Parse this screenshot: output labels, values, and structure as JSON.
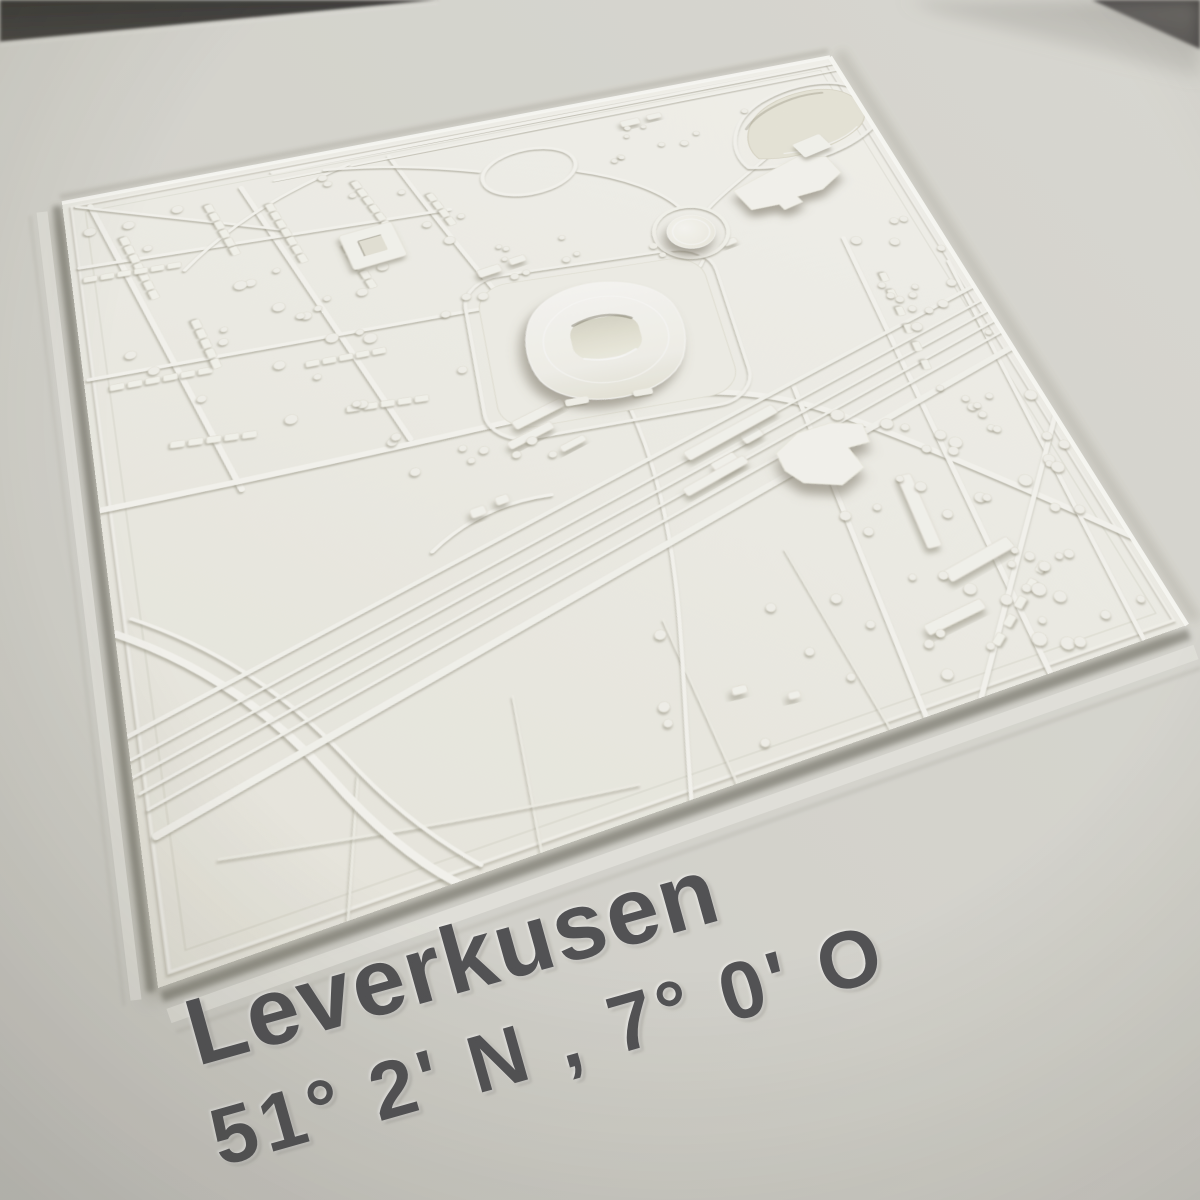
{
  "artwork": {
    "kind": "photograph of a white 3D-printed city relief map recessed in a paper mat",
    "city": "Leverkusen",
    "coordinates": "51° 2' N , 7° 0' O",
    "visible_features": [
      "stadium-bowl-with-recessed-pitch",
      "circular-gas-tank",
      "highway-interchange-loop",
      "pond-recess",
      "railway-track-band",
      "residential-house-rows",
      "tree-dots",
      "field-boundary-lines",
      "industrial-roof-blob",
      "courtyard-building"
    ]
  },
  "labels": {
    "city": "Leverkusen",
    "coords": "51° 2' N , 7° 0' O"
  },
  "palette": {
    "backdrop_dark": "#383633",
    "mat_paper": "#d7d6cf",
    "plate_white": "#f3f2ea",
    "relief_bright": "#f9f8f2",
    "recess_tone": "#e7e5d7",
    "caption_text": "#47474a"
  }
}
